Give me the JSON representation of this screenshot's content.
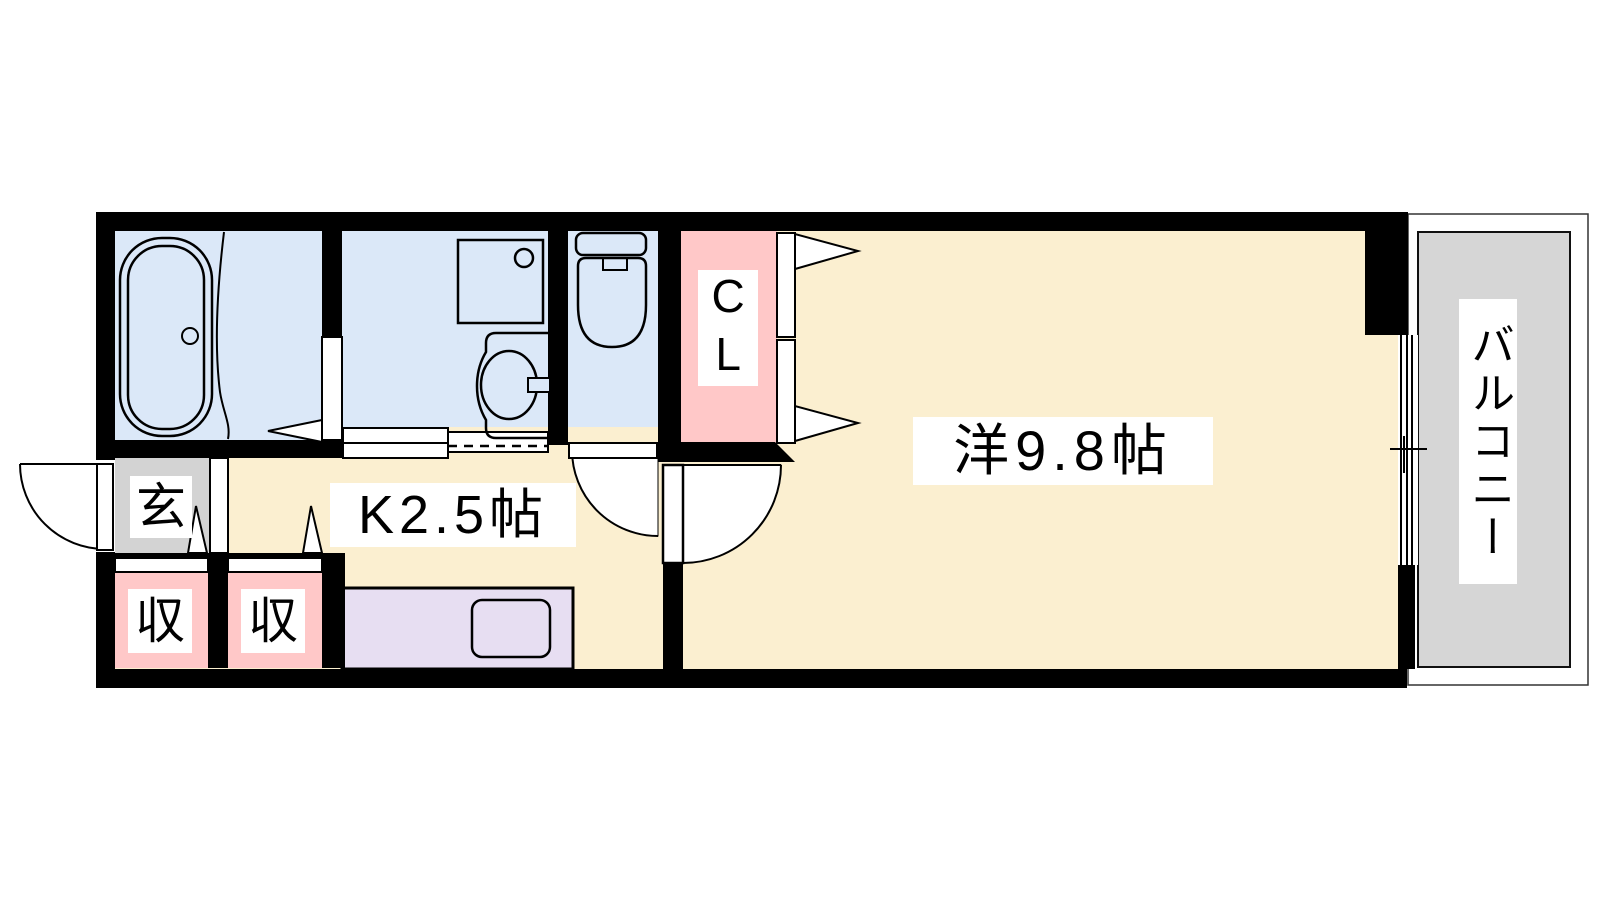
{
  "floor_plan": {
    "labels": {
      "entrance": "玄",
      "storage_left": "収",
      "storage_right": "収",
      "kitchen": "K2.5帖",
      "closet": "CL",
      "western_room": "洋9.8帖",
      "balcony": "バルコニー"
    },
    "colors": {
      "canvas_bg": "#ffffff",
      "wall": "#000000",
      "line": "#000000",
      "wet_area_blue": "#dbe8f8",
      "floor_cream": "#fbefd0",
      "closet_pink": "#ffc8c8",
      "storage_pink": "#ffc8c8",
      "entrance_gray": "#d3d3d3",
      "balcony_gray": "#d6d6d6",
      "counter_lavender": "#e7def2",
      "label_bg": "#ffffff",
      "label_text": "#000000"
    },
    "fixtures": {
      "bathroom": [
        "bathtub"
      ],
      "washroom": [
        "washing-machine-pan",
        "vanity-sink"
      ],
      "toilet_room": [
        "toilet"
      ],
      "kitchen": [
        "kitchen-counter",
        "kitchen-sink"
      ],
      "openings": [
        "entrance-door",
        "bathroom-door",
        "washroom-sliding-door",
        "toilet-door",
        "room-door",
        "closet-folding-doors",
        "storage-doors",
        "balcony-sliding-window"
      ]
    }
  }
}
